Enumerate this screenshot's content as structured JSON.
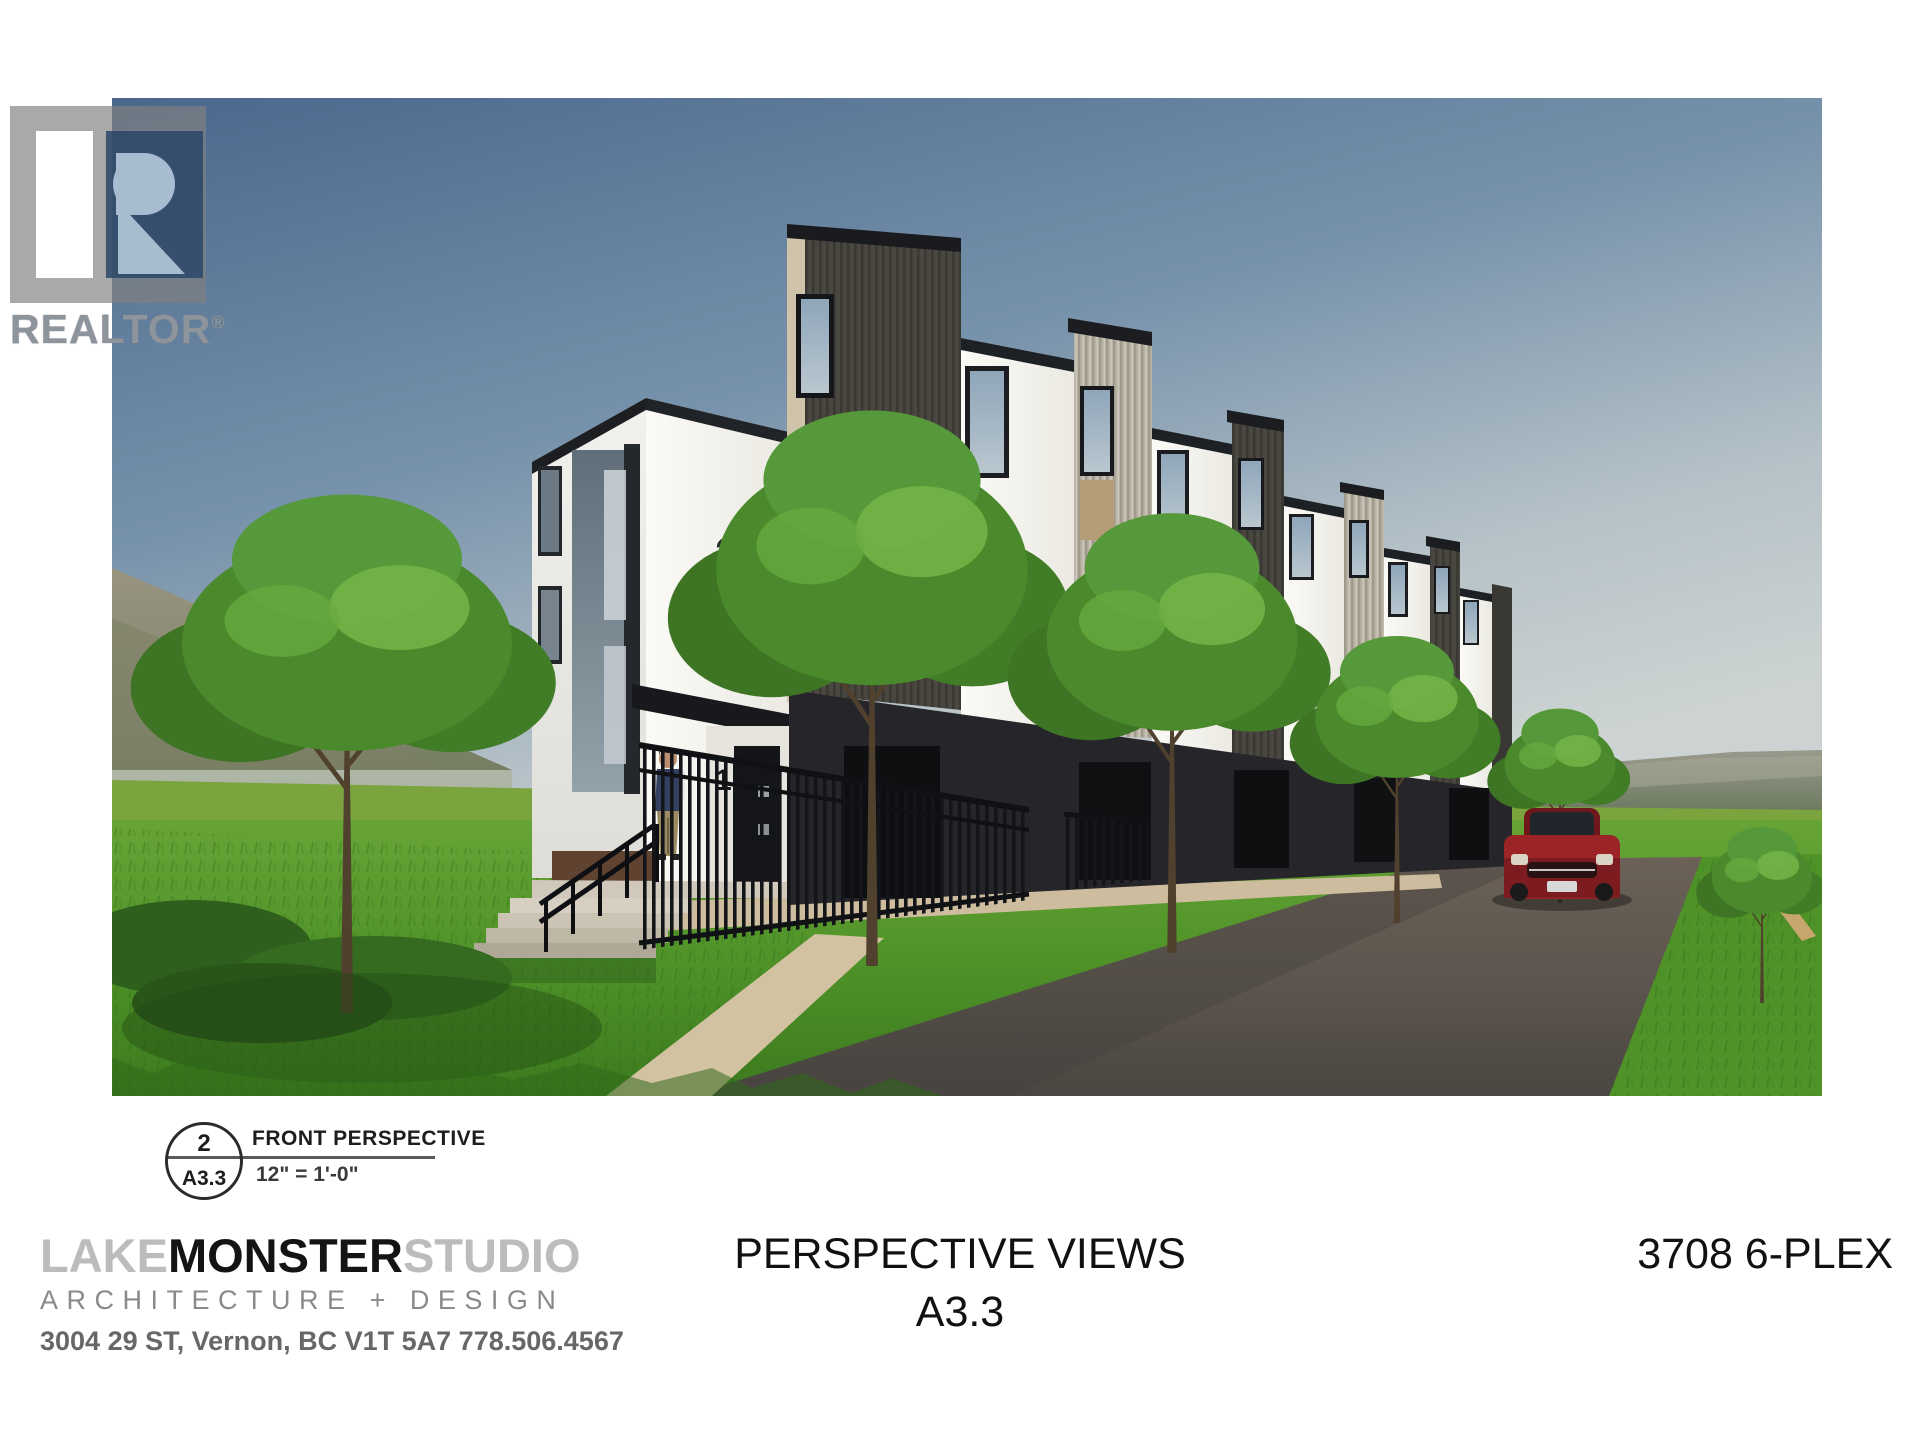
{
  "realtor": {
    "wordmark": "REALTOR",
    "registered": "®"
  },
  "rendering": {
    "description": "Photorealistic front perspective rendering of a modern flat-roof 6-plex townhouse row with trees, lawn, asphalt lane, red car and a person at the entry",
    "building_number": "3708",
    "unit_number": "1",
    "colors": {
      "sky_top": "#49688c",
      "sky_horizon": "#ccd3d2",
      "field_green": "#7ba33e",
      "lawn_green": "#4f9328",
      "road_asphalt": "#5d564e",
      "stucco_white": "#f6f5f1",
      "siding_dark": "#4a4741",
      "siding_light": "#b9b3a6",
      "parapet_black": "#1d2024",
      "car_red": "#8e2024",
      "path_tan": "#cdbd9e"
    }
  },
  "callout": {
    "number": "2",
    "sheet": "A3.3",
    "title": "FRONT PERSPECTIVE",
    "scale": "12\" = 1'-0\""
  },
  "footer": {
    "firm": {
      "name_part1": "LAKE",
      "name_part2": "MONSTER",
      "name_part3": "STUDIO",
      "tagline": "ARCHITECTURE + DESIGN",
      "address": "3004 29 ST, Vernon, BC V1T 5A7 778.506.4567"
    },
    "sheet_title": "PERSPECTIVE VIEWS",
    "sheet_number": "A3.3",
    "project": "3708 6-PLEX"
  }
}
